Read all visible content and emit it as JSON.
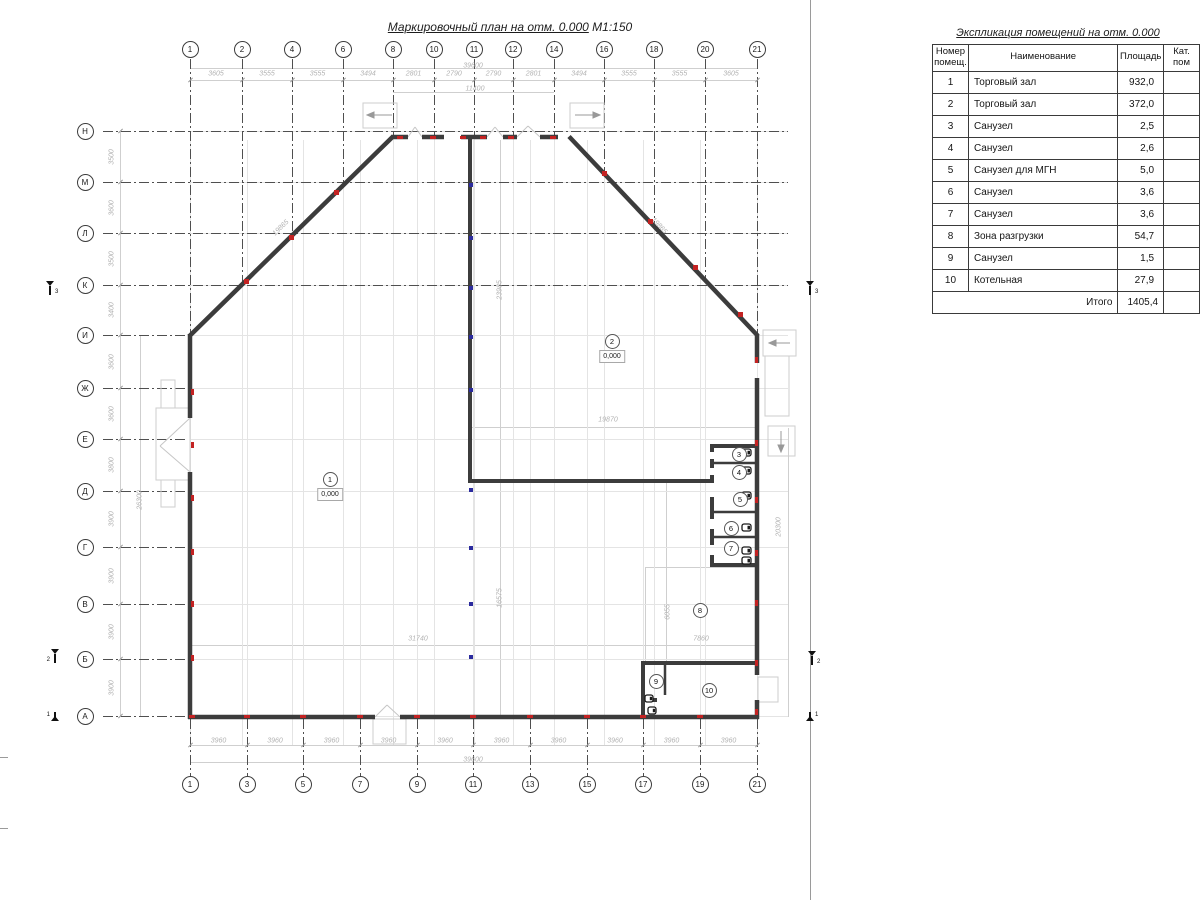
{
  "plan": {
    "title": "Маркировочный план на отм. 0.000",
    "scale": "М1:150",
    "axes_top": {
      "labels": [
        "1",
        "2",
        "4",
        "6",
        "8",
        "10",
        "11",
        "12",
        "14",
        "16",
        "18",
        "20",
        "21"
      ],
      "x": [
        190,
        242,
        292,
        343,
        393,
        434,
        474,
        513,
        554,
        604,
        654,
        705,
        757
      ],
      "dark_end": [
        335,
        284,
        235,
        185,
        137,
        137,
        137,
        137,
        137,
        173,
        226,
        280,
        335
      ],
      "dims": [
        "3605",
        "3555",
        "3555",
        "3494",
        "2801",
        "2790",
        "2790",
        "2801",
        "3494",
        "3555",
        "3555",
        "3605"
      ],
      "total": "39600",
      "inner_dim": {
        "text": "11400",
        "x1": 393,
        "x2": 554
      }
    },
    "axes_bottom": {
      "labels": [
        "1",
        "3",
        "5",
        "7",
        "9",
        "11",
        "13",
        "15",
        "17",
        "19",
        "21"
      ],
      "x": [
        190,
        247,
        303,
        360,
        417,
        473,
        530,
        587,
        643,
        700,
        757
      ],
      "dims": [
        "3960",
        "3960",
        "3960",
        "3960",
        "3960",
        "3960",
        "3960",
        "3960",
        "3960",
        "3960"
      ],
      "total": "39600"
    },
    "axes_left": {
      "labels": [
        "Н",
        "М",
        "Л",
        "К",
        "И",
        "Ж",
        "Е",
        "Д",
        "Г",
        "В",
        "Б",
        "А"
      ],
      "y": [
        131,
        182,
        233,
        285,
        335,
        388,
        439,
        491,
        547,
        604,
        659,
        716
      ],
      "dims": [
        "3500",
        "3600",
        "3500",
        "3400",
        "3600",
        "3600",
        "3800",
        "3900",
        "3900",
        "3900",
        "3900"
      ]
    },
    "rooms": [
      {
        "num": "1",
        "x": 330,
        "y": 479,
        "level": "0,000"
      },
      {
        "num": "2",
        "x": 612,
        "y": 341,
        "level": "0,000"
      },
      {
        "num": "3",
        "x": 739,
        "y": 454
      },
      {
        "num": "4",
        "x": 739,
        "y": 472
      },
      {
        "num": "5",
        "x": 740,
        "y": 499
      },
      {
        "num": "6",
        "x": 731,
        "y": 528
      },
      {
        "num": "7",
        "x": 731,
        "y": 548
      },
      {
        "num": "8",
        "x": 700,
        "y": 610
      },
      {
        "num": "9",
        "x": 656,
        "y": 681
      },
      {
        "num": "10",
        "x": 709,
        "y": 690
      }
    ],
    "annotations": [
      {
        "t": "39600",
        "x": 473,
        "y": 66,
        "r": 0
      },
      {
        "t": "11400",
        "x": 475,
        "y": 89,
        "r": 0
      },
      {
        "t": "39600",
        "x": 473,
        "y": 760,
        "r": 0
      },
      {
        "t": "26300",
        "x": 140,
        "y": 500,
        "r": -90
      },
      {
        "t": "20300",
        "x": 779,
        "y": 527,
        "r": -90
      },
      {
        "t": "23985",
        "x": 500,
        "y": 290,
        "r": -90
      },
      {
        "t": "16575",
        "x": 500,
        "y": 598,
        "r": -90
      },
      {
        "t": "19870",
        "x": 608,
        "y": 420,
        "r": 0
      },
      {
        "t": "6055",
        "x": 668,
        "y": 612,
        "r": -90
      },
      {
        "t": "31740",
        "x": 418,
        "y": 639,
        "r": 0
      },
      {
        "t": "7860",
        "x": 701,
        "y": 639,
        "r": 0
      },
      {
        "t": "19865",
        "x": 281,
        "y": 228,
        "r": -44
      },
      {
        "t": "19865",
        "x": 659,
        "y": 226,
        "r": 47
      }
    ],
    "guide_lines": [
      [
        190,
        68,
        567,
        "h"
      ],
      [
        190,
        80,
        567,
        "h"
      ],
      [
        393,
        92,
        161,
        "h"
      ],
      [
        190,
        745,
        567,
        "h"
      ],
      [
        190,
        762,
        567,
        "h"
      ],
      [
        120,
        131,
        586,
        "v"
      ],
      [
        140,
        335,
        382,
        "v"
      ],
      [
        788,
        428,
        289,
        "v"
      ],
      [
        500,
        140,
        577,
        "v"
      ],
      [
        666,
        483,
        178,
        "v"
      ],
      [
        470,
        427,
        287,
        "h"
      ],
      [
        190,
        645,
        567,
        "h"
      ],
      [
        645,
        567,
        112,
        "h"
      ],
      [
        645,
        567,
        96,
        "v"
      ]
    ],
    "markers_red_h": [
      [
        192,
        716
      ],
      [
        247,
        716
      ],
      [
        303,
        716
      ],
      [
        360,
        716
      ],
      [
        417,
        716
      ],
      [
        473,
        716
      ],
      [
        530,
        716
      ],
      [
        587,
        716
      ],
      [
        643,
        716
      ],
      [
        700,
        716
      ],
      [
        400,
        137
      ],
      [
        433,
        137
      ],
      [
        463,
        137
      ],
      [
        483,
        137
      ],
      [
        511,
        137
      ],
      [
        553,
        137
      ]
    ],
    "markers_red_v": [
      [
        192,
        392
      ],
      [
        192,
        445
      ],
      [
        192,
        498
      ],
      [
        192,
        552
      ],
      [
        192,
        604
      ],
      [
        192,
        658
      ],
      [
        756,
        360
      ],
      [
        756,
        443
      ],
      [
        756,
        500
      ],
      [
        756,
        553
      ],
      [
        756,
        603
      ],
      [
        756,
        663
      ],
      [
        756,
        712
      ]
    ],
    "markers_red_d": [
      [
        246,
        281
      ],
      [
        291,
        237
      ],
      [
        336,
        192
      ],
      [
        604,
        173
      ],
      [
        650,
        221
      ],
      [
        695,
        267
      ],
      [
        740,
        314
      ]
    ],
    "markers_blue": [
      [
        471,
        185
      ],
      [
        471,
        238
      ],
      [
        471,
        288
      ],
      [
        471,
        337
      ],
      [
        471,
        390
      ],
      [
        471,
        490
      ],
      [
        471,
        548
      ],
      [
        471,
        604
      ],
      [
        471,
        657
      ]
    ],
    "section_markers": [
      {
        "num": "3",
        "x": 44,
        "y": 285,
        "flag": "up",
        "side": "right"
      },
      {
        "num": "3",
        "x": 804,
        "y": 285,
        "flag": "up",
        "side": "right"
      },
      {
        "num": "2",
        "x": 49,
        "y": 653,
        "flag": "up",
        "side": "left"
      },
      {
        "num": "2",
        "x": 806,
        "y": 655,
        "flag": "up",
        "side": "right"
      },
      {
        "num": "1",
        "x": 49,
        "y": 708,
        "flag": "down",
        "side": "left"
      },
      {
        "num": "1",
        "x": 804,
        "y": 708,
        "flag": "down",
        "side": "right"
      }
    ]
  },
  "table": {
    "title": "Экспликация помещений на отм. 0.000",
    "col_headers": [
      "Номер помещ.",
      "Наименование",
      "Площадь",
      "Кат. пом"
    ],
    "rows": [
      [
        "1",
        "Торговый зал",
        "932,0"
      ],
      [
        "2",
        "Торговый зал",
        "372,0"
      ],
      [
        "3",
        "Санузел",
        "2,5"
      ],
      [
        "4",
        "Санузел",
        "2,6"
      ],
      [
        "5",
        "Санузел для МГН",
        "5,0"
      ],
      [
        "6",
        "Санузел",
        "3,6"
      ],
      [
        "7",
        "Санузел",
        "3,6"
      ],
      [
        "8",
        "Зона разгрузки",
        "54,7"
      ],
      [
        "9",
        "Санузел",
        "1,5"
      ],
      [
        "10",
        "Котельная",
        "27,9"
      ]
    ],
    "total_label": "Итого",
    "total_value": "1405,4"
  }
}
